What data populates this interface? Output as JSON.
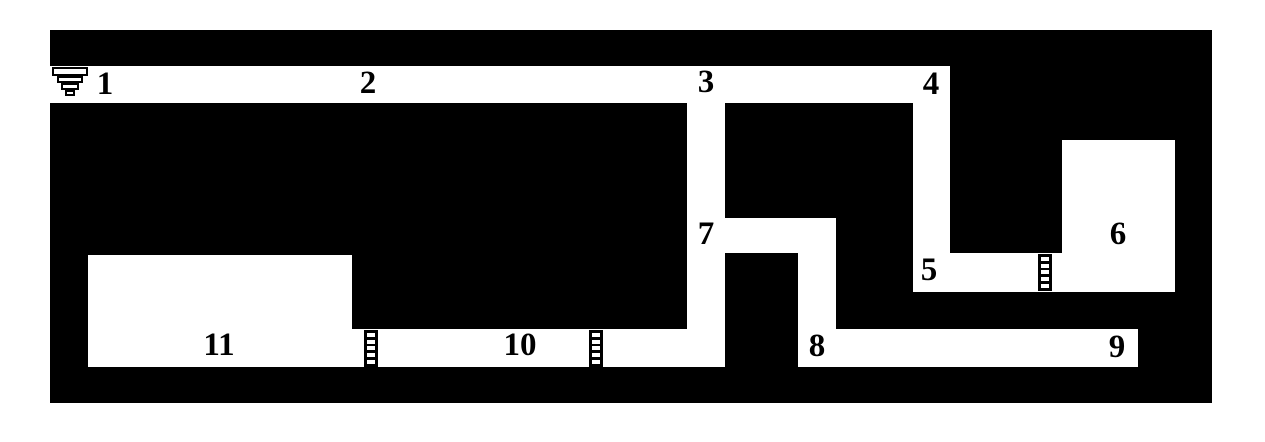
{
  "map": {
    "description": "Black-and-white dungeon level map with numbered passages and rooms",
    "colors": {
      "wall": "#000000",
      "floor": "#ffffff",
      "page_background": "#ffffff",
      "label_text": "#000000"
    },
    "bounds": {
      "x": 50,
      "y": 30,
      "width": 1162,
      "height": 373
    },
    "areas": [
      {
        "name": "passage-1-2-3-4-top-corridor",
        "x": 50,
        "y": 66,
        "width": 900,
        "height": 37
      },
      {
        "name": "shaft-below-3",
        "x": 687,
        "y": 103,
        "width": 38,
        "height": 264
      },
      {
        "name": "passage-7",
        "x": 687,
        "y": 218,
        "width": 149,
        "height": 35
      },
      {
        "name": "shaft-7-to-8",
        "x": 798,
        "y": 253,
        "width": 38,
        "height": 76
      },
      {
        "name": "passage-8-9",
        "x": 798,
        "y": 329,
        "width": 340,
        "height": 38
      },
      {
        "name": "passage-10",
        "x": 352,
        "y": 329,
        "width": 373,
        "height": 38
      },
      {
        "name": "room-11",
        "x": 88,
        "y": 255,
        "width": 264,
        "height": 112
      },
      {
        "name": "shaft-below-4",
        "x": 913,
        "y": 103,
        "width": 37,
        "height": 189
      },
      {
        "name": "passage-5",
        "x": 913,
        "y": 253,
        "width": 262,
        "height": 39
      },
      {
        "name": "room-6",
        "x": 1062,
        "y": 140,
        "width": 113,
        "height": 152
      }
    ],
    "labels": [
      {
        "text": "1",
        "cx": 105,
        "cy": 86
      },
      {
        "text": "2",
        "cx": 368,
        "cy": 85
      },
      {
        "text": "3",
        "cx": 706,
        "cy": 84
      },
      {
        "text": "4",
        "cx": 931,
        "cy": 86
      },
      {
        "text": "5",
        "cx": 929,
        "cy": 272
      },
      {
        "text": "6",
        "cx": 1118,
        "cy": 236
      },
      {
        "text": "7",
        "cx": 706,
        "cy": 236
      },
      {
        "text": "8",
        "cx": 817,
        "cy": 348
      },
      {
        "text": "9",
        "cx": 1117,
        "cy": 349
      },
      {
        "text": "10",
        "cx": 520,
        "cy": 347
      },
      {
        "text": "11",
        "cx": 219,
        "cy": 347
      }
    ],
    "ladders": [
      {
        "name": "ladder-icon-passage-10-left",
        "x": 364,
        "y": 330,
        "rungs": 5
      },
      {
        "name": "ladder-icon-passage-10-right",
        "x": 589,
        "y": 330,
        "rungs": 5
      },
      {
        "name": "ladder-icon-passage-5",
        "x": 1038,
        "y": 254,
        "rungs": 5
      }
    ],
    "stairs": {
      "name": "stairs-down-icon-location-1",
      "x": 52,
      "y": 67,
      "steps": [
        {
          "width": 36,
          "height": 9
        },
        {
          "width": 26,
          "height": 7
        },
        {
          "width": 18,
          "height": 7
        },
        {
          "width": 10,
          "height": 6
        }
      ]
    }
  }
}
